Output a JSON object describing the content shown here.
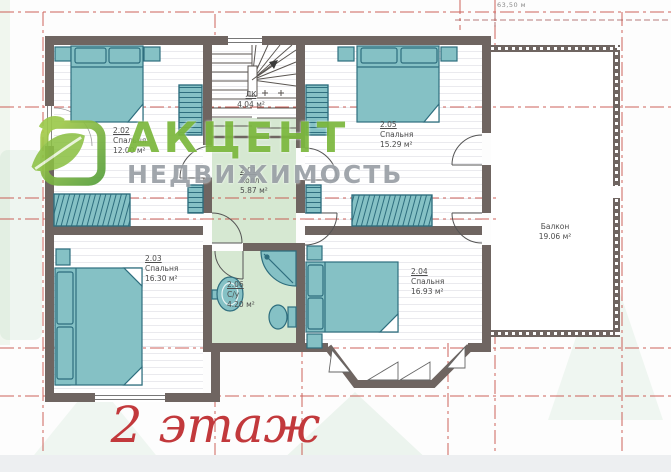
{
  "title": {
    "floor": "2 этаж"
  },
  "dimension": {
    "top_right": "63,50 м"
  },
  "watermark": {
    "brand": "АКЦЕНТ",
    "subtitle": "НЕДВИЖИМОСТЬ"
  },
  "rooms": [
    {
      "id": "2.01",
      "name": "Холл",
      "area": "5.87 м²"
    },
    {
      "id": "2.02",
      "name": "Спальня",
      "area": "12.00 м²"
    },
    {
      "id": "2.03",
      "name": "Спальня",
      "area": "16.30 м²"
    },
    {
      "id": "2.04",
      "name": "Спальня",
      "area": "16.93 м²"
    },
    {
      "id": "2.05",
      "name": "Спальня",
      "area": "15.29 м²"
    },
    {
      "id": "2.06",
      "name": "С/у",
      "area": "4.20 м²"
    }
  ],
  "stairs": {
    "id": "ЛК",
    "area": "4.04 м²"
  },
  "balcony": {
    "name": "Балкон",
    "area": "19.06 м²"
  },
  "colors": {
    "wall": "#6f6561",
    "furniture": "#85c1c5",
    "furniture_stroke": "#2e6e7e",
    "hall_floor": "#d6e8d2",
    "axis_red": "#c5473f",
    "brand_green": "#7cb83e",
    "brand_gray": "#9aa0a6",
    "floor_title_red": "#c2393c"
  }
}
